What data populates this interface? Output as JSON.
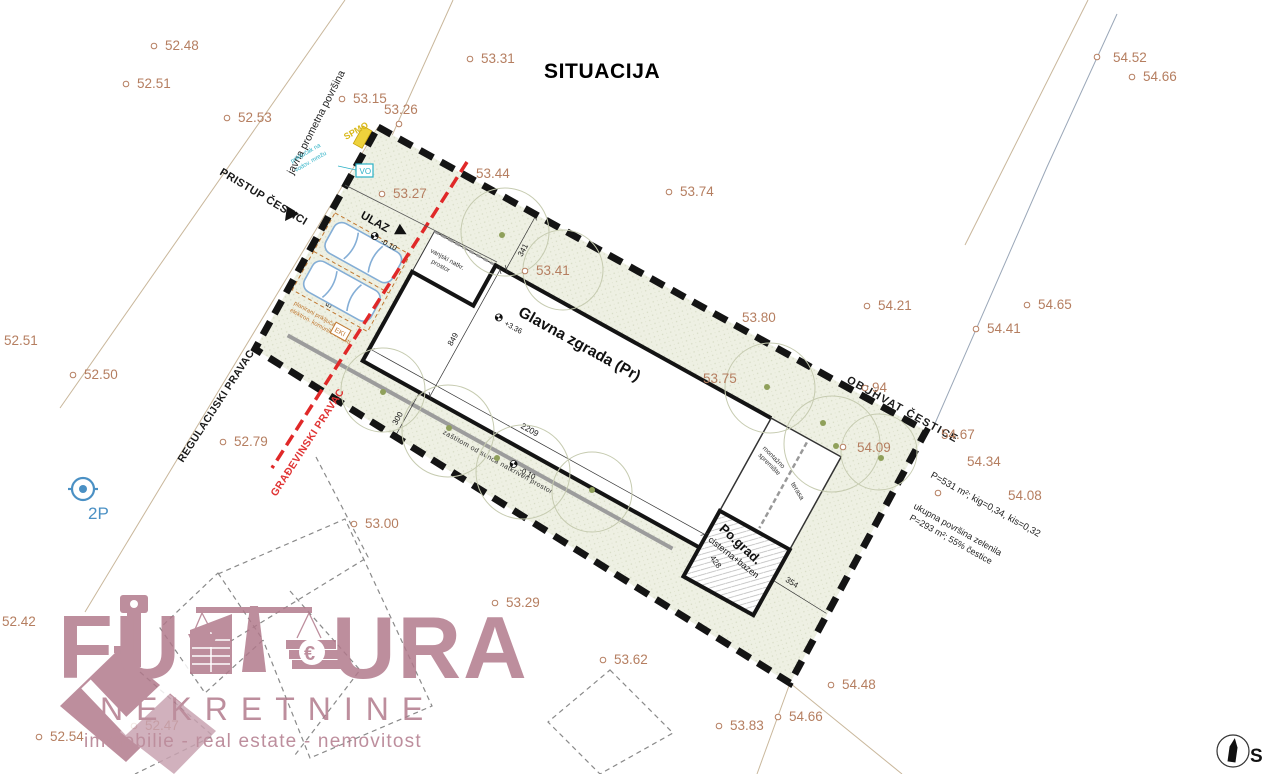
{
  "title": "SITUACIJA",
  "north": "S",
  "streets": {
    "pristup": "PRISTUP ČESTICI",
    "javna": "javna prometna površina",
    "regulacijski": "REGULACIJSKI PRAVAC",
    "gradevinski": "GRAĐEVINSKI PRAVAC",
    "obuhvat": "OBUHVAT ČESTICE"
  },
  "site": {
    "glavna": "Glavna zgrada (Pr)",
    "glavna_elev": "+3.36",
    "ulaz": "ULAZ",
    "ulaz_elev": "-0.10",
    "porch1": "vanjski natkr.",
    "porch2": "prostor",
    "canopy": "zaštitom od sunca natkriven prostor",
    "canopy_elev": "-0.10",
    "shed1": "montažno",
    "shed2": "spremište",
    "terasa": "terasa",
    "pograd": "Po.grad.",
    "cisterna": "cisterna+bazen"
  },
  "dims": {
    "a": "341",
    "b": "849",
    "c": "2209",
    "d": "300",
    "e": "588",
    "f": "428",
    "g": "354",
    "h": "2"
  },
  "utilities": {
    "vo_box": "VO",
    "vo1": "priključak na",
    "vo2": "vodov. mrežu",
    "spmo": "SPMO",
    "eki_box": "EKI",
    "eki1": "planirani priključak na",
    "eki2": "elektron. komunik. infrastr.",
    "parking_mark": "2P"
  },
  "stats": {
    "l1": "P=531 m²; kig=0,34, kis=0,32",
    "l2": "ukupna površina zelenila",
    "l3": "P=293 m²; 55% čestice"
  },
  "elevations": [
    {
      "v": "52.48"
    },
    {
      "v": "52.51"
    },
    {
      "v": "52.53"
    },
    {
      "v": "53.15"
    },
    {
      "v": "53.26"
    },
    {
      "v": "53.31"
    },
    {
      "v": "53.44"
    },
    {
      "v": "53.27"
    },
    {
      "v": "53.74"
    },
    {
      "v": "54.52"
    },
    {
      "v": "54.66"
    },
    {
      "v": "53.41"
    },
    {
      "v": "53.80"
    },
    {
      "v": "54.21"
    },
    {
      "v": "54.65"
    },
    {
      "v": "54.41"
    },
    {
      "v": "52.51"
    },
    {
      "v": "52.50"
    },
    {
      "v": "53.75"
    },
    {
      "v": "94"
    },
    {
      "v": "54.67"
    },
    {
      "v": "54.34"
    },
    {
      "v": "54.09"
    },
    {
      "v": "54.08"
    },
    {
      "v": "52.79"
    },
    {
      "v": "53.00"
    },
    {
      "v": "53.29"
    },
    {
      "v": "53.62"
    },
    {
      "v": "54.48"
    },
    {
      "v": "53.83"
    },
    {
      "v": "54.66"
    },
    {
      "v": "52.42"
    },
    {
      "v": "52.54"
    },
    {
      "v": "52.47"
    }
  ],
  "logo": {
    "fu": "FU",
    "ura": "URA",
    "nekretnine": "NEKRETNINE",
    "tagline": "immobilie - real estate - nemovitost",
    "euro": "€"
  },
  "colors": {
    "elevation": "#b57e60",
    "boundary": "#141414",
    "red_line": "#e02828",
    "hatch_fill": "#eef0e3",
    "logo_rose": "#b1798b",
    "cyan": "#2ab0c5",
    "orange": "#c07830",
    "yellow": "#eed23c",
    "car_blue": "#84aed6",
    "blue_mark": "#4a90c4"
  }
}
